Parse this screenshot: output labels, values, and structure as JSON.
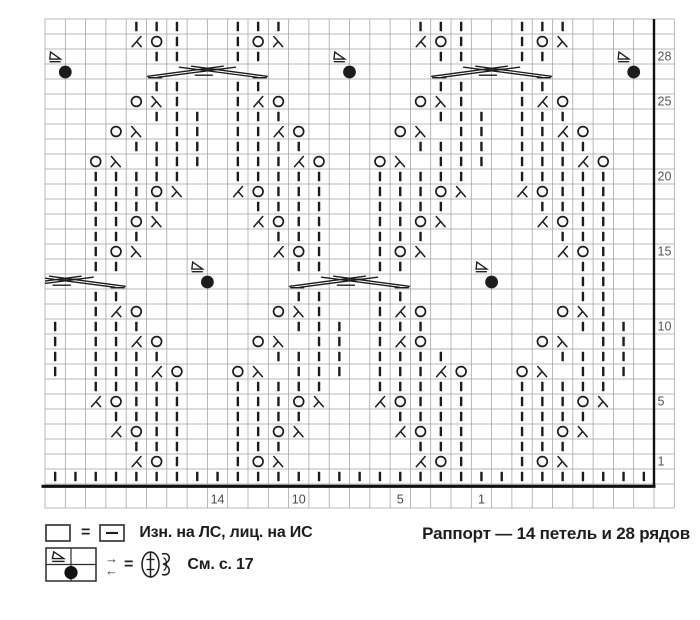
{
  "caption": "Раппорт — 14 петель и 28 рядов",
  "legend": {
    "row1_equals": "=",
    "row1_text": "Изн. на ЛС, лиц. на ИС",
    "row2_equals": "=",
    "row2_text": "См. с. 17",
    "rs_arrow": "→",
    "ws_arrow": "←"
  },
  "colors": {
    "ink": "#1c1c1c",
    "grid": "#a0a0a0",
    "heavy": "#111111",
    "label": "#555555",
    "col_label": "#4a4a4a"
  },
  "chart": {
    "type": "knitting-chart",
    "rapport_stitches": 14,
    "rapport_rows": 28,
    "columns": 30,
    "rows": 31,
    "symbols": {
      "I": "knit-stitch-bar",
      "O": "yarn-over-circle",
      "L": "left-leaning-decrease",
      "R": "right-leaning-decrease",
      "T": "triangle-marker",
      "D": "black-dot-marker",
      ".": "empty-purl-cell"
    },
    "cells": [
      "....III..III......III..III....",
      "....LOI..IOR......LOI..IOR....",
      "T....II..II...T....II..II...T.",
      "D.............D.............D.",
      ".....II..II........II..II.....",
      "....ORI..ILO......ORI..ILO....",
      ".....III.III.......III.III....",
      "...OR.II.IILO....OR.II.IILO...",
      "....IIII.IIII.....IIII.IIII...",
      "..OR.III.IIILO..OR.III.IIILO..",
      "..IIIII..IIIII..IIIII..IIIII..",
      "..IIIOR..LOIII..IIIOR..LOIII..",
      "..IIII....IIII..IIII....IIII..",
      "..IIOR....LOII..IIOR....LOII..",
      "..III......III..III......III..",
      "..IOR......LOI..IOR......LOI..",
      "..II...T....II..II...T....II..",
      ".......D.............D....II..",
      "..II........II..II........II..",
      "..ILO......ORI..ILO......ORI..",
      "I.III.......III.III.......III.",
      "I.IILO....OR.II.ILO.....OR.II.",
      "I.IIII.....IIII.IIII.....IIII.",
      "I.IIILO..OR.III.IIILO..OR.III.",
      "..IIIII..IIIII..IIIII..IIIII..",
      "..LOIII..IIIOR..LOIII..IIIOR..",
      "...IIII..IIII....IIII..IIII...",
      "...LOII..IIOR....LOII..IIOR...",
      "....III..III......III..III....",
      "....LOI..IOR......LOI..IOR....",
      "IIIIIIIIIIIIIIIIIIIIIIIIIIIIII"
    ],
    "cables": [
      {
        "row": 3,
        "col_start": 5,
        "col_end": 10
      },
      {
        "row": 3,
        "col_start": 19,
        "col_end": 24
      },
      {
        "row": 17,
        "col_start": -2,
        "col_end": 3
      },
      {
        "row": 17,
        "col_start": 12,
        "col_end": 17
      }
    ],
    "row_labels": [
      {
        "row": 2,
        "label": "28"
      },
      {
        "row": 5,
        "label": "25"
      },
      {
        "row": 10,
        "label": "20"
      },
      {
        "row": 15,
        "label": "15"
      },
      {
        "row": 20,
        "label": "10"
      },
      {
        "row": 25,
        "label": "5"
      },
      {
        "row": 29,
        "label": "1"
      }
    ],
    "col_labels": [
      {
        "col": 8,
        "label": "14"
      },
      {
        "col": 12,
        "label": "10"
      },
      {
        "col": 17,
        "label": "5"
      },
      {
        "col": 21,
        "label": "1"
      }
    ]
  }
}
